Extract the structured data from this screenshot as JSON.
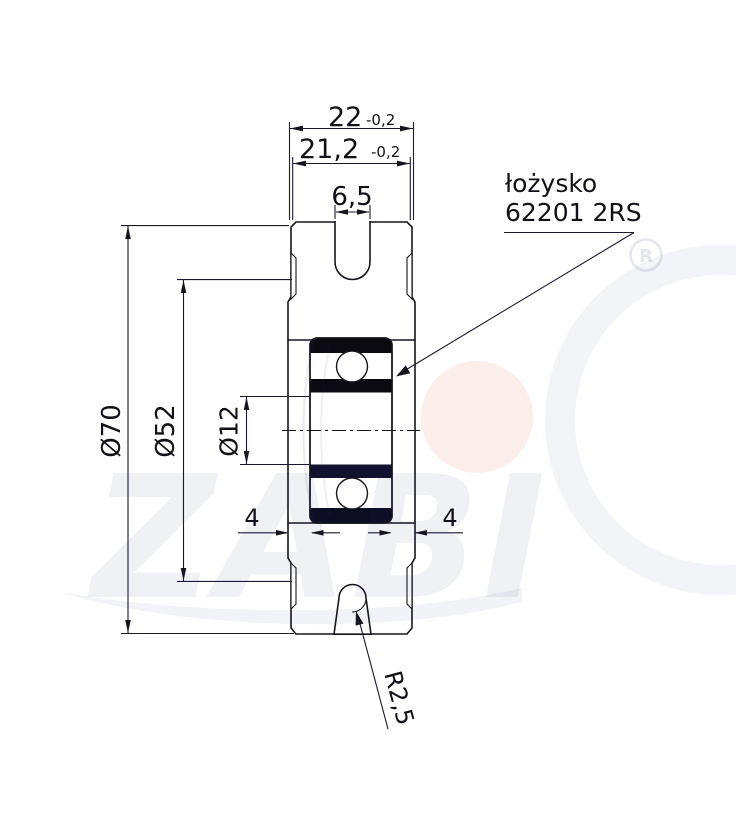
{
  "drawing": {
    "title": "pulley wheel cross-section technical drawing",
    "dimensions": {
      "outer_width": {
        "value": "22",
        "tolerance": "-0,2"
      },
      "rim_width": {
        "value": "21,2",
        "tolerance": "-0,2"
      },
      "groove_width": {
        "value": "6,5"
      },
      "outer_diameter": {
        "value": "Ø70"
      },
      "groove_diameter": {
        "value": "Ø52"
      },
      "bore_diameter": {
        "value": "Ø12"
      },
      "bearing_offset_left": {
        "value": "4"
      },
      "bearing_offset_right": {
        "value": "4"
      },
      "bottom_groove_radius": {
        "value": "R2,5"
      }
    },
    "callout": {
      "line1": "łożysko",
      "line2": "62201 2RS"
    },
    "watermark": {
      "brand": "ZABI",
      "registered_mark": "R",
      "gray": "#eef0f5",
      "accent_pink": "#fcebe7"
    },
    "colors": {
      "line": "#15151d",
      "bearing_black": "#0a0a10",
      "bearing_navy": "#12122e"
    }
  }
}
